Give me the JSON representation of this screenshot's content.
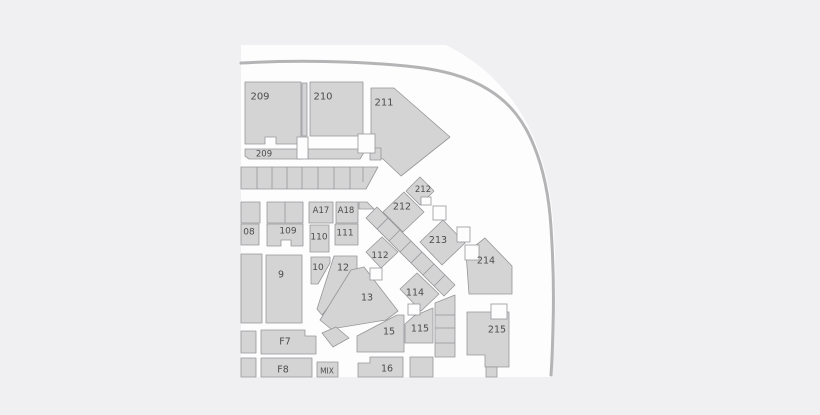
{
  "map": {
    "title": "arena-seating-chart",
    "colors": {
      "page_background": "#f0f0f2",
      "surface": "#fdfdfd",
      "section_fill": "#d4d4d5",
      "section_border": "#96969a",
      "wall": "#b4b4b6",
      "label": "#4c4c4c"
    },
    "surface_path": "M241,45 L446,45 C468,56 488,71 505,91 C523,112 535,137 543,164 C551,191 554,222 555,253 C556,294 555,338 552,377 L241,377 Z",
    "wall_path": "M241,63 C295,60 355,61 406,66 C441,69.5 467,76 489,90 C510,103 524,121 534,146 C543,168 549,196 551,227 C553,257 554,296 553,327 C552.6,345 552,361 551,375",
    "sections": [
      {
        "id": "section-209-upper",
        "label": "209",
        "points": "245,82 301,82 301,144 276,144 276,137 265,137 265,144 245,144",
        "lx": 260,
        "ly": 97,
        "fs": 10
      },
      {
        "id": "stairs-209-210",
        "label": "",
        "points": "302,83 307,83 307,136 302,136"
      },
      {
        "id": "section-210",
        "label": "210",
        "points": "310,82 363,82 363,136 310,136",
        "lx": 323,
        "ly": 97,
        "fs": 10
      },
      {
        "id": "section-211",
        "label": "211",
        "points": "371,88 394,88 450,137 401,176 383,159 375,158 371,152",
        "lx": 384,
        "ly": 103,
        "fs": 10
      },
      {
        "id": "section-209-lower",
        "label": "209",
        "points": "245,149 302,149 302,159 249,159 245,156",
        "lx": 264,
        "ly": 154.5,
        "fs": 8.5
      },
      {
        "id": "strip-under-210",
        "label": "",
        "points": "308,149 366,149 360,159 308,159"
      },
      {
        "id": "strip-under-211",
        "label": "",
        "points": "370,148 381,148 381,160 370,160"
      },
      {
        "id": "terrace-row",
        "label": "",
        "points": "241,167 378,167 366,189 241,189"
      },
      {
        "id": "row-block-a",
        "label": "",
        "points": "241,202 260,202 260,223 241,223"
      },
      {
        "id": "row-block-b",
        "label": "",
        "points": "267,202 303,202 303,223 267,223"
      },
      {
        "id": "section-a17",
        "label": "A17",
        "points": "309,202 333,202 333,223 309,223",
        "lx": 321,
        "ly": 211,
        "fs": 8.5
      },
      {
        "id": "section-a18",
        "label": "A18",
        "points": "336,202 358,202 358,223 336,223",
        "lx": 346,
        "ly": 211,
        "fs": 8.5
      },
      {
        "id": "a18-corner-wedge",
        "label": "",
        "points": "359,202 367,202 374,209 359,209"
      },
      {
        "id": "section-108",
        "label": "08",
        "points": "241,224 259,224 259,245 241,245",
        "lx": 249,
        "ly": 232.5,
        "fs": 9
      },
      {
        "id": "section-109",
        "label": "109",
        "points": "267,224 303,224 303,246 291,246 291,240 281,240 281,246 267,246",
        "lx": 288,
        "ly": 231.5,
        "fs": 9
      },
      {
        "id": "section-110",
        "label": "110",
        "points": "310,225 329,225 329,252 310,252",
        "lx": 319,
        "ly": 237.5,
        "fs": 9
      },
      {
        "id": "section-111",
        "label": "111",
        "points": "335,224 358,224 358,245 335,245",
        "lx": 345,
        "ly": 233.5,
        "fs": 9
      },
      {
        "id": "stair-band",
        "label": "",
        "points": "366,218 377,207 455,285 444,296"
      },
      {
        "id": "section-212-small",
        "label": "212",
        "points": "420,177 434,191 420,205 406,191",
        "lx": 423,
        "ly": 190,
        "fs": 8.5
      },
      {
        "id": "section-212",
        "label": "212",
        "points": "404,192 424,212 403,232 383,212",
        "lx": 402,
        "ly": 207,
        "fs": 9.5
      },
      {
        "id": "section-213",
        "label": "213",
        "points": "443,220 465,243 442,265 420,242",
        "lx": 438,
        "ly": 240.5,
        "fs": 9.5
      },
      {
        "id": "section-214",
        "label": "214",
        "points": "485,238 512,266 512,294 469,294 466,253",
        "lx": 486,
        "ly": 261,
        "fs": 9.5
      },
      {
        "id": "section-215",
        "label": "215",
        "points": "467,312 509,312 509,367 485,367 485,355 467,355",
        "lx": 497,
        "ly": 330,
        "fs": 9.5
      },
      {
        "id": "section-215-tab",
        "label": "",
        "points": "486,367 497,367 497,377 486,377"
      },
      {
        "id": "section-9",
        "label": "9",
        "points": "266,255 302,255 302,323 266,323",
        "lx": 281,
        "ly": 275,
        "fs": 9.5
      },
      {
        "id": "left-column-block",
        "label": "",
        "points": "241,254 262,254 262,323 241,323"
      },
      {
        "id": "section-10",
        "label": "10",
        "points": "311,257 330,257 330,263 318,284 311,284",
        "lx": 318,
        "ly": 268,
        "fs": 9
      },
      {
        "id": "section-12",
        "label": "12",
        "points": "334,256 357,256 357,271 322,315 317,309",
        "lx": 343,
        "ly": 268,
        "fs": 9.5
      },
      {
        "id": "section-13",
        "label": "13",
        "points": "320,320 351,270 364,267 398,311 386,320 331,329",
        "lx": 367,
        "ly": 298,
        "fs": 9.5
      },
      {
        "id": "wedge-13-tip",
        "label": "",
        "points": "322,333 336,327 349,338 333,347"
      },
      {
        "id": "section-112",
        "label": "112",
        "points": "366,252 382,237 398,252 381,268",
        "lx": 380,
        "ly": 256,
        "fs": 9
      },
      {
        "id": "section-114",
        "label": "114",
        "points": "400,289 417,273 439,294 421,311",
        "lx": 415,
        "ly": 293,
        "fs": 9.5
      },
      {
        "id": "section-15",
        "label": "15",
        "points": "357,336 397,315 404,315 404,352 357,352",
        "lx": 389,
        "ly": 332,
        "fs": 9.5
      },
      {
        "id": "section-115",
        "label": "115",
        "points": "405,324 414,316 433,308 433,343 405,343",
        "lx": 420,
        "ly": 329,
        "fs": 9.5
      },
      {
        "id": "stair-column",
        "label": "",
        "points": "435,303 455,295 455,357 435,357"
      },
      {
        "id": "section-16",
        "label": "16",
        "points": "358,363 370,363 370,357 403,357 403,377 358,377",
        "lx": 387,
        "ly": 369,
        "fs": 9.5
      },
      {
        "id": "block-right-of-16",
        "label": "",
        "points": "410,357 433,357 433,377 410,377"
      },
      {
        "id": "section-f7",
        "label": "F7",
        "points": "261,330 305,330 305,336 316,336 316,354 261,354",
        "lx": 285,
        "ly": 342,
        "fs": 9.5
      },
      {
        "id": "f7-left-cell",
        "label": "",
        "points": "241,331 256,331 256,353 241,353"
      },
      {
        "id": "section-f8",
        "label": "F8",
        "points": "261,358 312,358 312,377 261,377",
        "lx": 283,
        "ly": 370,
        "fs": 9.5
      },
      {
        "id": "f8-left-cell",
        "label": "",
        "points": "241,358 256,358 256,377 241,377"
      },
      {
        "id": "section-mix",
        "label": "MIX",
        "points": "317,362 338,362 338,377 317,377",
        "lx": 327,
        "ly": 371,
        "fs": 7.5
      }
    ],
    "divider_lines": [
      "257,167 257,189",
      "272,167 272,189",
      "287,167 287,189",
      "302,167 302,189",
      "318,167 318,189",
      "334,167 334,189",
      "350,167 350,189",
      "363,167 363,182",
      "285,202 285,223",
      "377,229 388,218",
      "389,241 400,230",
      "400,252 411,241",
      "411,263 422,252",
      "423,275 434,264",
      "434,286 445,275",
      "435,315 455,315",
      "435,328 455,328",
      "435,343 455,343"
    ],
    "aisle_boxes": [
      {
        "x": 297,
        "y": 137,
        "w": 11,
        "h": 22
      },
      {
        "x": 358,
        "y": 134,
        "w": 17,
        "h": 19
      },
      {
        "x": 433,
        "y": 206,
        "w": 13,
        "h": 14
      },
      {
        "x": 457,
        "y": 227,
        "w": 13,
        "h": 15
      },
      {
        "x": 465,
        "y": 245,
        "w": 14,
        "h": 15
      },
      {
        "x": 491,
        "y": 304,
        "w": 16,
        "h": 15
      },
      {
        "x": 370,
        "y": 268,
        "w": 12,
        "h": 12
      },
      {
        "x": 408,
        "y": 304,
        "w": 12,
        "h": 11
      },
      {
        "x": 421,
        "y": 197,
        "w": 10,
        "h": 8
      }
    ]
  }
}
